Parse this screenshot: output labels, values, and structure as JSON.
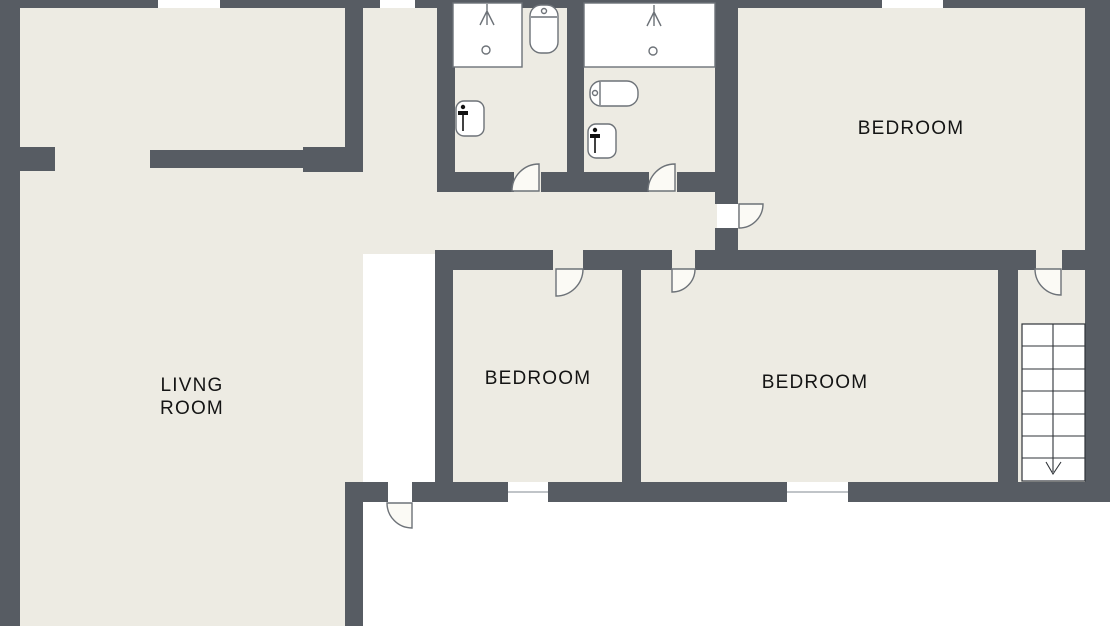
{
  "plan": {
    "type": "floor-plan",
    "colors": {
      "wall": "#575c63",
      "floor": "#edebe3",
      "background": "#ffffff",
      "fixture_stroke": "#6d7278",
      "stair_line": "#2f3338",
      "text": "#141414"
    },
    "rooms": {
      "living": {
        "label_line1": "LIVNG",
        "label_line2": "ROOM"
      },
      "bedroom_top_right": {
        "label": "BEDROOM"
      },
      "bedroom_middle": {
        "label": "BEDROOM"
      },
      "bedroom_right": {
        "label": "BEDROOM"
      }
    },
    "bathrooms": [
      {
        "name": "bathroom-1",
        "fixtures": [
          "shower",
          "toilet",
          "sink"
        ]
      },
      {
        "name": "bathroom-2",
        "fixtures": [
          "shower",
          "toilet",
          "sink"
        ]
      }
    ],
    "stairs": {
      "steps": 7,
      "direction": "down"
    },
    "doors": 7,
    "windows": 5
  }
}
